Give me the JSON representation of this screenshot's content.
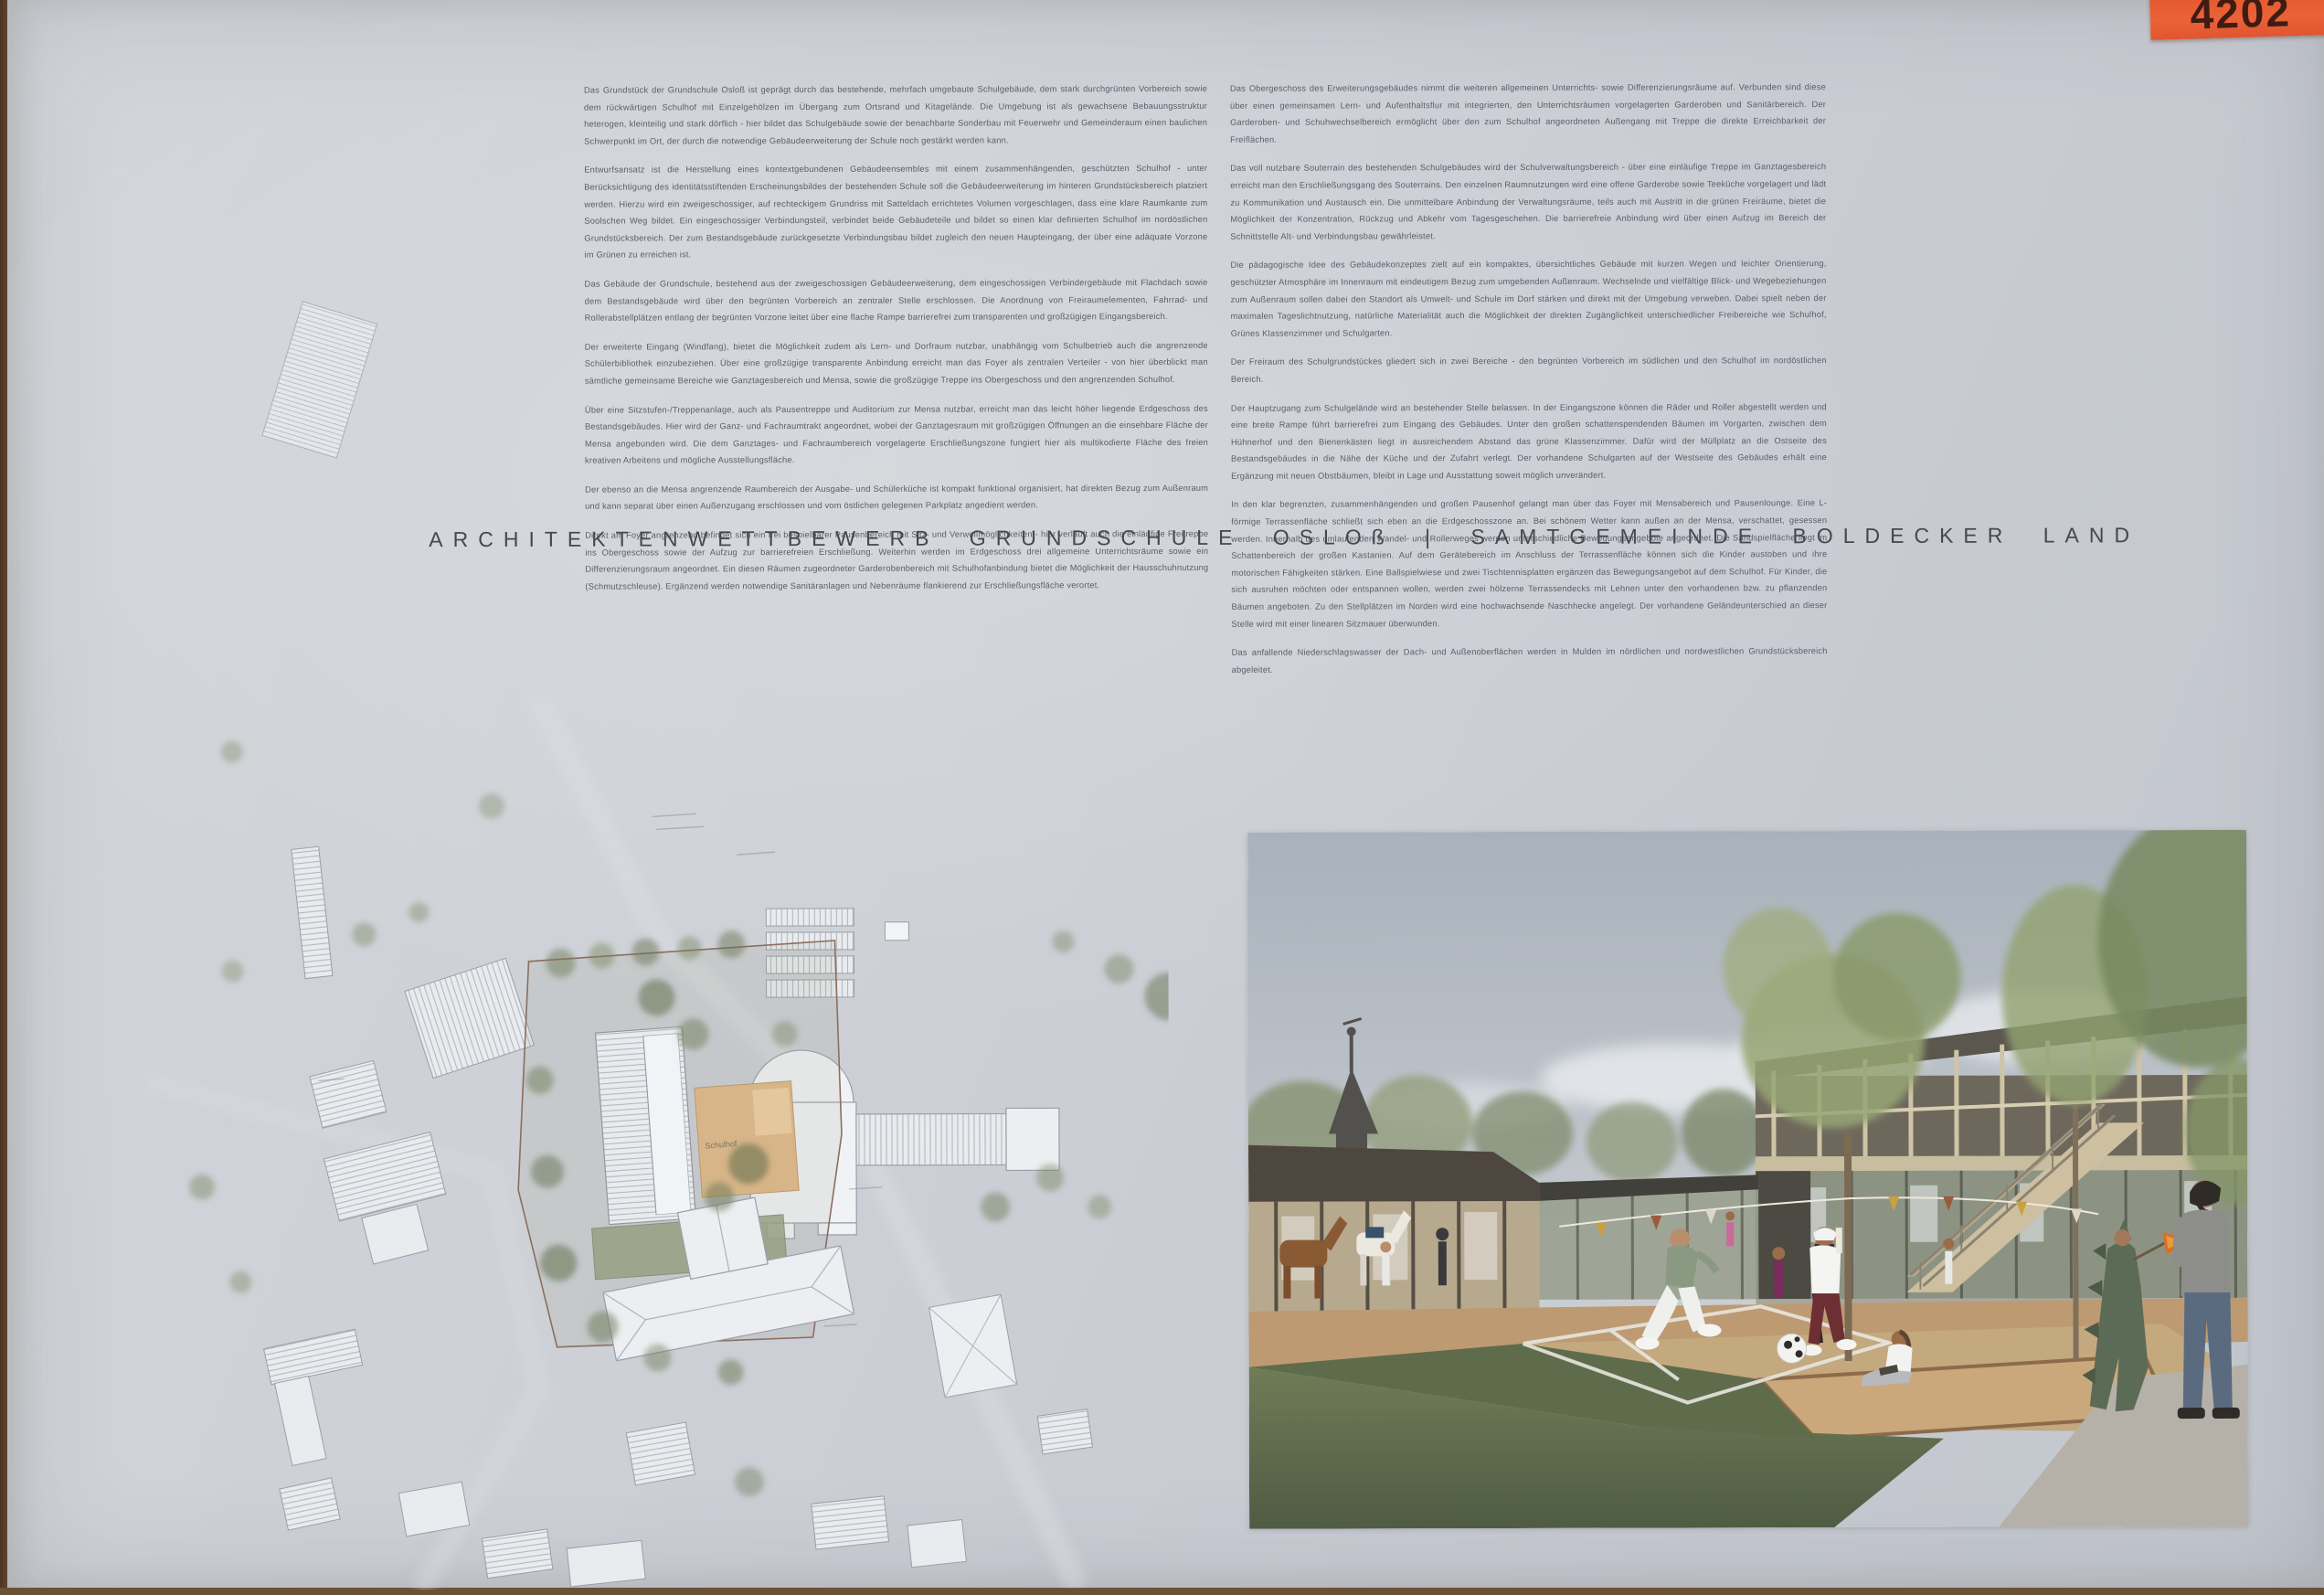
{
  "tag": {
    "number": "4202"
  },
  "title": "ARCHITEKTENWETTBEWERB GRUNDSCHULE OSLOß | SAMTGEMEINDE BOLDECKER LAND",
  "text_columns": {
    "left": {
      "p1": "Das Grundstück der Grundschule Osloß ist geprägt durch das bestehende, mehrfach umgebaute Schulgebäude, dem stark durchgrünten Vorbereich sowie dem rückwärtigen Schulhof mit Einzelgehölzen im Übergang zum Ortsrand und Kitagelände. Die Umgebung ist als gewachsene Bebauungsstruktur heterogen, kleinteilig und stark dörflich - hier bildet das Schulgebäude sowie der benachbarte Sonderbau mit Feuerwehr und Gemeinderaum einen baulichen Schwerpunkt im Ort, der durch die notwendige Gebäudeerweiterung der Schule noch gestärkt werden kann.",
      "p2": "Entwurfsansatz ist die Herstellung eines kontextgebundenen Gebäudeensembles mit einem zusammenhängenden, geschützten Schulhof - unter Berücksichtigung des identitätsstiftenden Erscheinungsbildes der bestehenden Schule soll die Gebäudeerweiterung im hinteren Grundstücksbereich platziert werden. Hierzu wird ein zweigeschossiger, auf rechteckigem Grundriss mit Satteldach errichtetes Volumen vorgeschlagen, dass eine klare Raumkante zum Soolschen Weg bildet. Ein eingeschossiger Verbindungsteil, verbindet beide Gebäudeteile und bildet so einen klar definierten Schulhof im nordöstlichen Grundstücksbereich. Der zum Bestandsgebäude zurückgesetzte Verbindungsbau bildet zugleich den neuen Haupteingang, der über eine adäquate Vorzone im Grünen zu erreichen ist.",
      "p3": "Das Gebäude der Grundschule, bestehend aus der zweigeschossigen Gebäudeerweiterung, dem eingeschossigen Verbindergebäude mit Flachdach sowie dem Bestandsgebäude wird über den begrünten Vorbereich an zentraler Stelle erschlossen. Die Anordnung von Freiraumelementen, Fahrrad- und Rollerabstellplätzen entlang der begrünten Vorzone leitet über eine flache Rampe barrierefrei zum transparenten und großzügigen Eingangsbereich.",
      "p4": "Der erweiterte Eingang (Windfang), bietet die Möglichkeit zudem als Lern- und Dorfraum nutzbar, unabhängig vom Schulbetrieb auch die angrenzende Schülerbibliothek einzubeziehen. Über eine großzügige transparente Anbindung erreicht man das Foyer als zentralen Verteiler - von hier überblickt man sämtliche gemeinsame Bereiche wie Ganztagesbereich und Mensa, sowie die großzügige Treppe ins Obergeschoss und den angrenzenden Schulhof.",
      "p5": "Über eine Sitzstufen-/Treppenanlage, auch als Pausentreppe und Auditorium zur Mensa nutzbar, erreicht man das leicht höher liegende Erdgeschoss des Bestandsgebäudes. Hier wird der Ganz- und Fachraumtrakt angeordnet, wobei der Ganztagesraum mit großzügigen Öffnungen an die einsehbare Fläche der Mensa angebunden wird. Die dem Ganztages- und Fachraumbereich vorgelagerte Erschließungszone fungiert hier als multikodierte Fläche des freien kreativen Arbeitens und mögliche Ausstellungsfläche.",
      "p6": "Der ebenso an die Mensa angrenzende Raumbereich der Ausgabe- und Schülerküche ist kompakt funktional organisiert, hat direkten Bezug zum Außenraum und kann separat über einen Außenzugang erschlossen und vom östlichen gelegenen Parkplatz angedient werden.",
      "p7": "Direkt am Foyer angrenzend befindet sich ein frei bespielbarer Pausenbereich mit Sitz- und Verweilmöglichkeiten - hier verläuft auch die einläufige Freitreppe ins Obergeschoss sowie der Aufzug zur barrierefreien Erschließung. Weiterhin werden im Erdgeschoss drei allgemeine Unterrichtsräume sowie ein Differenzierungsraum angeordnet. Ein diesen Räumen zugeordneter Garderobenbereich mit Schulhofanbindung bietet die Möglichkeit der Hausschuhnutzung (Schmutzschleuse). Ergänzend werden notwendige Sanitäranlagen und Nebenräume flankierend zur Erschließungsfläche verortet."
    },
    "right": {
      "p1": "Das Obergeschoss des Erweiterungsgebäudes nimmt die weiteren allgemeinen Unterrichts- sowie Differenzierungsräume auf. Verbunden sind diese über einen gemeinsamen Lern- und Aufenthaltsflur mit integrierten, den Unterrichtsräumen vorgelagerten Garderoben und Sanitärbereich. Der Garderoben- und Schuhwechselbereich ermöglicht über den zum Schulhof angeordneten Außengang mit Treppe die direkte Erreichbarkeit der Freiflächen.",
      "p2": "Das voll nutzbare Souterrain des bestehenden Schulgebäudes wird der Schulverwaltungsbereich - über eine einläufige Treppe im Ganztagesbereich erreicht man den Erschließungsgang des Souterrains. Den einzelnen Raumnutzungen wird eine offene Garderobe sowie Teeküche vorgelagert und lädt zu Kommunikation und Austausch ein. Die unmittelbare Anbindung der Verwaltungsräume, teils auch mit Austritt in die grünen Freiräume, bietet die Möglichkeit der Konzentration, Rückzug und Abkehr vom Tagesgeschehen. Die barrierefreie Anbindung wird über einen Aufzug im Bereich der Schnittstelle Alt- und Verbindungsbau gewährleistet.",
      "p3": "Die pädagogische Idee des Gebäudekonzeptes zielt auf ein kompaktes, übersichtliches Gebäude mit kurzen Wegen und leichter Orientierung, geschützter Atmosphäre im Innenraum mit eindeutigem Bezug zum umgebenden Außenraum. Wechselnde und vielfältige Blick- und Wegebeziehungen zum Außenraum sollen dabei den Standort als Umwelt- und Schule im Dorf stärken und direkt mit der Umgebung verweben. Dabei spielt neben der maximalen Tageslichtnutzung, natürliche Materialität auch die Möglichkeit der direkten Zugänglichkeit unterschiedlicher Freibereiche wie Schulhof, Grünes Klassenzimmer und Schulgarten.",
      "p4": "Der Freiraum des Schulgrundstückes gliedert sich in zwei Bereiche - den begrünten Vorbereich im südlichen und den Schulhof im nordöstlichen Bereich.",
      "p5": "Der Hauptzugang zum Schulgelände wird an bestehender Stelle belassen. In der Eingangszone können die Räder und Roller abgestellt werden und eine breite Rampe führt barrierefrei zum Eingang des Gebäudes. Unter den großen schattenspendenden Bäumen im Vorgarten, zwischen dem Hühnerhof und den Bienenkästen liegt in ausreichendem Abstand das grüne Klassenzimmer. Dafür wird der Müllplatz an die Ostseite des Bestandsgebäudes in die Nähe der Küche und der Zufahrt verlegt. Der vorhandene Schulgarten auf der Westseite des Gebäudes erhält eine Ergänzung mit neuen Obstbäumen, bleibt in Lage und Ausstattung soweit möglich unverändert.",
      "p6": "In den klar begrenzten, zusammenhängenden und großen Pausenhof gelangt man über das Foyer mit Mensabereich und Pausenlounge. Eine L-förmige Terrassenfläche schließt sich eben an die Erdgeschosszone an. Bei schönem Wetter kann außen an der Mensa, verschattet, gesessen werden. Innerhalb des umlaufenden Wandel- und Rollerweges werden unterschiedliche Bewegungsangebote angeordnet. Die Sandspielfläche liegt im Schattenbereich der großen Kastanien. Auf dem Gerätebereich im Anschluss der Terrassenfläche können sich die Kinder austoben und ihre motorischen Fähigkeiten stärken. Eine Ballspielwiese und zwei Tischtennisplatten ergänzen das Bewegungsangebot auf dem Schulhof. Für Kinder, die sich ausruhen möchten oder entspannen wollen, werden zwei hölzerne Terrassendecks mit Lehnen unter den vorhandenen bzw. zu pflanzenden Bäumen angeboten. Zu den Stellplätzen im Norden wird eine hochwachsende Naschhecke angelegt. Der vorhandene Geländeunterschied an dieser Stelle wird mit einer linearen Sitzmauer überwunden.",
      "p7": "Das anfallende Niederschlagswasser der Dach- und Außenoberflächen werden in Mulden im nördlichen und nordwestlichen Grundstücksbereich abgeleitet."
    }
  },
  "site_plan": {
    "label_schulhof": "Schulhof"
  },
  "colors": {
    "tag_orange": "#e4572e",
    "paper": "#cdd0d6",
    "text_gray": "#585d66",
    "courtyard_tan": "#d7b588",
    "lawn_green": "#66744f"
  }
}
